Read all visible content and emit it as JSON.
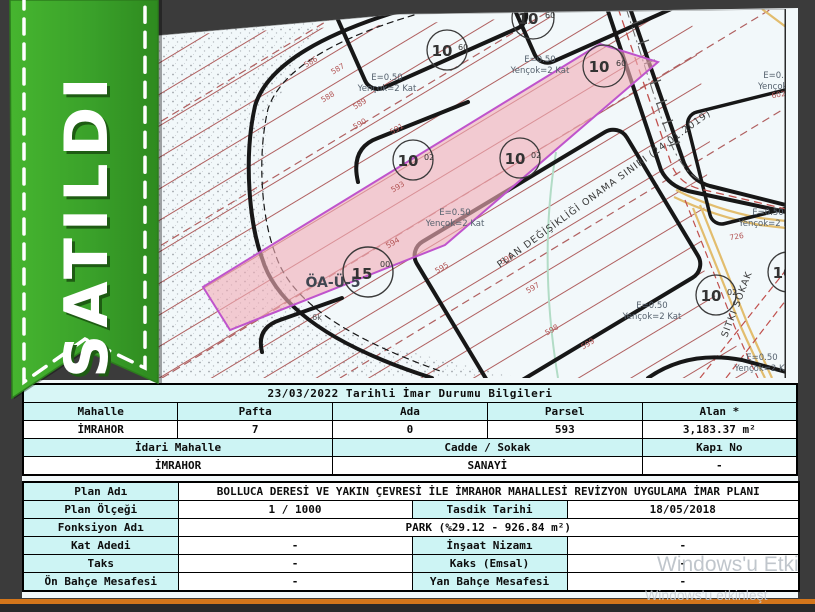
{
  "window": {
    "background_color": "#3b3b3b",
    "orange_bar_color": "#d4761b",
    "paper_color": "#f2f8fa"
  },
  "ribbon": {
    "label": "SATILDI",
    "color": "#3aa12a"
  },
  "watermark": {
    "line1": "Windows'u Etki",
    "line2": "Windows'u etkinleşt"
  },
  "map": {
    "highlight_color": "#f2afb8",
    "highlight_border": "#bf54cc",
    "hatch_color": "#b06060",
    "plan_boundary_label": "PLAN DEĞİŞİKLİĞİ ONAMA SINIRI (24.01.2019)",
    "street_label": "SITKI SOKAK",
    "area_label": "ÖA-Ü-5",
    "small_label": "6k",
    "zoning_labels": [
      {
        "l1": "E=0.50",
        "l2": "Yençok=2 Kat"
      },
      {
        "l1": "E=0.50",
        "l2": "Yençok=2 Kat"
      },
      {
        "l1": "E=0.50",
        "l2": "Yençok=2"
      },
      {
        "l1": "E=0.50",
        "l2": "Yençok=2 Kat"
      },
      {
        "l1": "E=0.50",
        "l2": "Yençok=2 Kat"
      },
      {
        "l1": "E=0.50",
        "l2": "Yençok=2 Kat"
      },
      {
        "l1": "E=0.50",
        "l2": "Yençok=2 Ka"
      }
    ],
    "parcel_numbers": [
      "586",
      "587",
      "588",
      "589",
      "590",
      "591",
      "593",
      "594",
      "595",
      "596",
      "597",
      "598",
      "599",
      "602",
      "726"
    ],
    "road_markers": [
      {
        "main": "10",
        "sub": "60"
      },
      {
        "main": "10",
        "sub": "60"
      },
      {
        "main": "10",
        "sub": "60"
      },
      {
        "main": "10",
        "sub": "02"
      },
      {
        "main": "10",
        "sub": "02"
      },
      {
        "main": "15",
        "sub": "00"
      },
      {
        "main": "10",
        "sub": "02"
      },
      {
        "main": "10",
        "sub": ""
      }
    ]
  },
  "table": {
    "title": "23/03/2022 Tarihli İmar Durumu Bilgileri",
    "header_bg": "#cdf4f4",
    "parcel_headers": [
      "Mahalle",
      "Pafta",
      "Ada",
      "Parsel",
      "Alan *"
    ],
    "parcel_values": [
      "İMRAHOR",
      "7",
      "0",
      "593",
      "3,183.37 m²"
    ],
    "address_headers": [
      "İdari Mahalle",
      "Cadde / Sokak",
      "Kapı No"
    ],
    "address_values": [
      "İMRAHOR",
      "SANAYİ",
      "-"
    ],
    "plan_rows": {
      "plan_adi_label": "Plan Adı",
      "plan_adi_value": "BOLLUCA DERESİ VE YAKIN ÇEVRESİ İLE İMRAHOR MAHALLESİ REVİZYON UYGULAMA İMAR PLANI",
      "plan_olcegi_label": "Plan Ölçeği",
      "plan_olcegi_value": "1 / 1000",
      "tasdik_label": "Tasdik Tarihi",
      "tasdik_value": "18/05/2018",
      "fonksiyon_label": "Fonksiyon Adı",
      "fonksiyon_value": "PARK (%29.12 - 926.84 m²)",
      "kat_label": "Kat Adedi",
      "kat_value": "-",
      "insaat_label": "İnşaat Nizamı",
      "insaat_value": "-",
      "taks_label": "Taks",
      "taks_value": "-",
      "kaks_label": "Kaks (Emsal)",
      "kaks_value": "-",
      "on_bahce_label": "Ön Bahçe Mesafesi",
      "on_bahce_value": "-",
      "yan_bahce_label": "Yan Bahçe Mesafesi",
      "yan_bahce_value": "-"
    }
  }
}
